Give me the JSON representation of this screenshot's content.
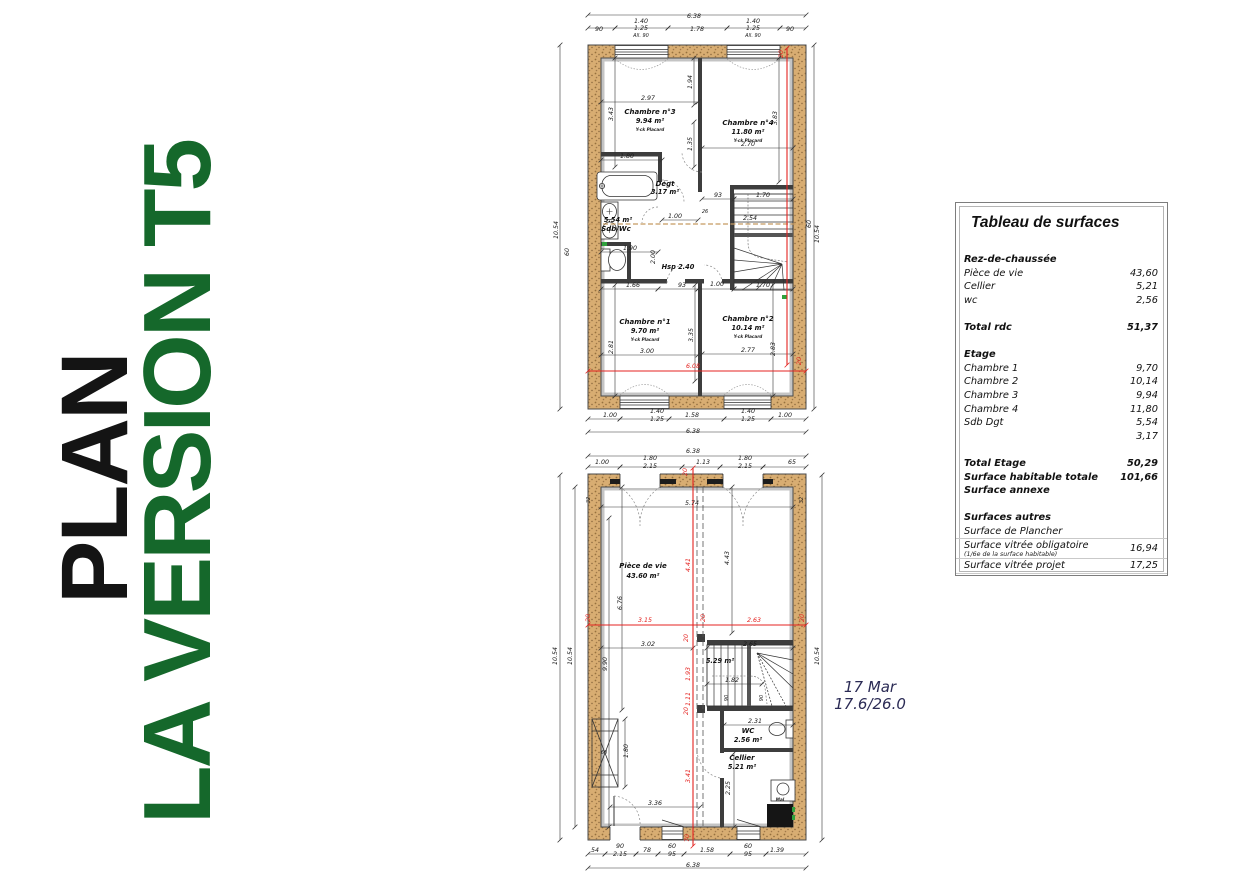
{
  "title": {
    "line1": "PLAN",
    "line2": "LA VERSION T5",
    "accent_color": "#15682b"
  },
  "note": {
    "date": "17 Mar",
    "temps": "17.6/26.0"
  },
  "table": {
    "title": "Tableau de surfaces",
    "rows": [
      {
        "l": "Rez-de-chaussée",
        "v": "",
        "b": 1
      },
      {
        "l": "Pièce de vie",
        "v": "43,60"
      },
      {
        "l": "Cellier",
        "v": "5,21"
      },
      {
        "l": "wc",
        "v": "2,56"
      },
      {
        "sp": 1
      },
      {
        "l": "Total rdc",
        "v": "51,37",
        "b": 1
      },
      {
        "sp": 1
      },
      {
        "l": "Etage",
        "v": "",
        "b": 1
      },
      {
        "l": "Chambre 1",
        "v": "9,70"
      },
      {
        "l": "Chambre 2",
        "v": "10,14"
      },
      {
        "l": "Chambre 3",
        "v": "9,94"
      },
      {
        "l": "Chambre 4",
        "v": "11,80"
      },
      {
        "l": "Sdb Dgt",
        "v": "5,54"
      },
      {
        "l": "",
        "v": "3,17"
      },
      {
        "sp": 1
      },
      {
        "l": "Total Etage",
        "v": "50,29",
        "b": 1
      },
      {
        "l": "Surface habitable totale",
        "v": "101,66",
        "b": 1
      },
      {
        "l": "Surface annexe",
        "v": "",
        "b": 1
      },
      {
        "sp": 1
      },
      {
        "l": "Surfaces autres",
        "v": "",
        "b": 1
      },
      {
        "l": "Surface de Plancher",
        "v": "",
        "hr": 1
      },
      {
        "l": "Surface vitrée obligatoire",
        "n": "(1/6e de la surface habitable)",
        "v": "16,94",
        "hr": 1
      },
      {
        "l": "Surface vitrée projet",
        "v": "17,25",
        "hr": 1
      }
    ]
  },
  "floors": {
    "upper": {
      "labels": [
        [
          142,
          16,
          "6.38"
        ],
        [
          47,
          29,
          "90"
        ],
        [
          89,
          21,
          "1.40"
        ],
        [
          89,
          28,
          "1.25"
        ],
        [
          89,
          35,
          "All. 90",
          "s"
        ],
        [
          145,
          29,
          "1.78"
        ],
        [
          201,
          21,
          "1.40"
        ],
        [
          201,
          28,
          "1.25"
        ],
        [
          201,
          35,
          "All. 90",
          "s"
        ],
        [
          238,
          29,
          "90"
        ],
        [
          6,
          228,
          "10.54",
          "r"
        ],
        [
          17,
          250,
          "60",
          "r"
        ],
        [
          259,
          222,
          "60",
          "r"
        ],
        [
          267,
          232,
          "10.54",
          "r"
        ],
        [
          98,
          112,
          "Chambre n°3",
          "b"
        ],
        [
          98,
          121,
          "9.94 m²",
          "a"
        ],
        [
          98,
          129,
          "Y-ck Placard",
          "t"
        ],
        [
          196,
          123,
          "Chambre n°4",
          "b"
        ],
        [
          196,
          132,
          "11.80 m²",
          "a"
        ],
        [
          196,
          140,
          "Y-ck Placard",
          "t"
        ],
        [
          93,
          322,
          "Chambre n°1",
          "b"
        ],
        [
          93,
          331,
          "9.70 m²",
          "a"
        ],
        [
          93,
          339,
          "Y-ck Placard",
          "t"
        ],
        [
          196,
          319,
          "Chambre n°2",
          "b"
        ],
        [
          196,
          328,
          "10.14 m²",
          "a"
        ],
        [
          196,
          336,
          "Y-ck Placard",
          "t"
        ],
        [
          113,
          184,
          "Dégt",
          "b"
        ],
        [
          113,
          192,
          "3.17 m²",
          "a"
        ],
        [
          66,
          220,
          "5.54 m²",
          "a"
        ],
        [
          64,
          229,
          "Sdb/Wc",
          "b"
        ],
        [
          126,
          267,
          "Hsp 2.40",
          "a"
        ],
        [
          96,
          98,
          "2.97"
        ],
        [
          61,
          112,
          "3.43",
          "r"
        ],
        [
          140,
          80,
          "1.94",
          "r"
        ],
        [
          140,
          142,
          "1.35",
          "r"
        ],
        [
          196,
          144,
          "2.70"
        ],
        [
          225,
          116,
          "3.83",
          "r"
        ],
        [
          75,
          156,
          "1.80"
        ],
        [
          166,
          195,
          "93"
        ],
        [
          211,
          195,
          "1.70"
        ],
        [
          153,
          211,
          "26",
          "s"
        ],
        [
          123,
          216,
          "1.00"
        ],
        [
          198,
          218,
          "2.54"
        ],
        [
          78,
          248,
          "1.90"
        ],
        [
          103,
          255,
          "2.00",
          "r"
        ],
        [
          81,
          285,
          "1.66"
        ],
        [
          130,
          285,
          "93"
        ],
        [
          165,
          284,
          "1.00"
        ],
        [
          211,
          285,
          "1.70"
        ],
        [
          95,
          351,
          "3.00"
        ],
        [
          196,
          350,
          "2.77"
        ],
        [
          141,
          333,
          "3.35",
          "r"
        ],
        [
          61,
          345,
          "2.81",
          "r"
        ],
        [
          223,
          347,
          "2.83",
          "r"
        ],
        [
          58,
          415,
          "1.00"
        ],
        [
          105,
          411,
          "1.40"
        ],
        [
          105,
          419,
          "1.25"
        ],
        [
          140,
          415,
          "1.58"
        ],
        [
          196,
          411,
          "1.40"
        ],
        [
          196,
          419,
          "1.25"
        ],
        [
          233,
          415,
          "1.00"
        ],
        [
          141,
          431,
          "6.38"
        ],
        [
          141,
          366,
          "6.08",
          "R"
        ],
        [
          249,
          359,
          "20",
          "Rr"
        ],
        [
          231,
          52,
          "20",
          "Rr"
        ]
      ],
      "dlines": [
        [
          36,
          13,
          254,
          13
        ],
        [
          36,
          26,
          63,
          26
        ],
        [
          63,
          26,
          116,
          26
        ],
        [
          116,
          26,
          175,
          26
        ],
        [
          175,
          26,
          228,
          26
        ],
        [
          228,
          26,
          254,
          26
        ],
        [
          8,
          43,
          8,
          407
        ],
        [
          262,
          43,
          262,
          407
        ],
        [
          49,
          100,
          146,
          100
        ],
        [
          49,
          158,
          110,
          158
        ],
        [
          150,
          146,
          241,
          146
        ],
        [
          63,
          56,
          63,
          165
        ],
        [
          142,
          56,
          142,
          103
        ],
        [
          142,
          120,
          142,
          165
        ],
        [
          227,
          56,
          227,
          180
        ],
        [
          150,
          197,
          182,
          197
        ],
        [
          182,
          197,
          241,
          197
        ],
        [
          110,
          218,
          146,
          218
        ],
        [
          49,
          250,
          106,
          250
        ],
        [
          49,
          287,
          106,
          287
        ],
        [
          106,
          287,
          146,
          287
        ],
        [
          146,
          287,
          182,
          287
        ],
        [
          182,
          287,
          241,
          287
        ],
        [
          49,
          353,
          146,
          353
        ],
        [
          150,
          352,
          241,
          352
        ],
        [
          63,
          283,
          63,
          394
        ],
        [
          143,
          283,
          143,
          379
        ],
        [
          221,
          283,
          221,
          394
        ],
        [
          36,
          417,
          68,
          417
        ],
        [
          68,
          417,
          117,
          417
        ],
        [
          117,
          417,
          172,
          417
        ],
        [
          172,
          417,
          219,
          417
        ],
        [
          219,
          417,
          254,
          417
        ],
        [
          36,
          430,
          254,
          430
        ],
        [
          36,
          369,
          254,
          369,
          "R"
        ],
        [
          235,
          46,
          235,
          363,
          "R"
        ]
      ]
    },
    "lower": {
      "labels": [
        [
          141,
          5,
          "6.38"
        ],
        [
          50,
          16,
          "1.00"
        ],
        [
          98,
          12,
          "1.80"
        ],
        [
          98,
          20,
          "2.15"
        ],
        [
          151,
          16,
          "1.13"
        ],
        [
          193,
          12,
          "1.80"
        ],
        [
          193,
          20,
          "2.15"
        ],
        [
          240,
          16,
          "65"
        ],
        [
          135,
          24,
          "20",
          "Rr"
        ],
        [
          5,
          208,
          "10.54",
          "r"
        ],
        [
          20,
          208,
          "10.54",
          "r"
        ],
        [
          267,
          208,
          "10.54",
          "r"
        ],
        [
          38,
          52,
          "32",
          "rs"
        ],
        [
          251,
          52,
          "32",
          "rs"
        ],
        [
          91,
          120,
          "Pièce de vie",
          "b"
        ],
        [
          91,
          130,
          "43.60 m²",
          "a"
        ],
        [
          168,
          215,
          "5.29 m²",
          "a"
        ],
        [
          196,
          285,
          "WC",
          "b"
        ],
        [
          196,
          294,
          "2.56 m²",
          "a"
        ],
        [
          190,
          312,
          "Cellier",
          "b"
        ],
        [
          190,
          321,
          "5.21 m²",
          "a"
        ],
        [
          228,
          353,
          "Mal",
          "t"
        ],
        [
          140,
          57,
          "5.74"
        ],
        [
          177,
          110,
          "4.43",
          "r"
        ],
        [
          55,
          216,
          "9.90",
          "r"
        ],
        [
          70,
          155,
          "6.76",
          "r"
        ],
        [
          96,
          198,
          "3.02"
        ],
        [
          198,
          198,
          "2.65"
        ],
        [
          180,
          234,
          "1.82"
        ],
        [
          176,
          250,
          "90",
          "rs"
        ],
        [
          211,
          250,
          "90",
          "rs"
        ],
        [
          203,
          275,
          "2.31"
        ],
        [
          178,
          340,
          "2.25",
          "r"
        ],
        [
          103,
          357,
          "3.36"
        ],
        [
          76,
          303,
          "1.80",
          "r"
        ],
        [
          52,
          306,
          "60",
          "s"
        ],
        [
          43,
          404,
          "54"
        ],
        [
          68,
          400,
          "90"
        ],
        [
          68,
          408,
          "2.15"
        ],
        [
          95,
          404,
          "78"
        ],
        [
          120,
          400,
          "60"
        ],
        [
          120,
          408,
          "95"
        ],
        [
          155,
          404,
          "1.58"
        ],
        [
          196,
          400,
          "60"
        ],
        [
          196,
          408,
          "95"
        ],
        [
          225,
          404,
          "1.39"
        ],
        [
          141,
          419,
          "6.38"
        ],
        [
          138,
          117,
          "4.41",
          "Rr"
        ],
        [
          93,
          174,
          "3.15",
          "R"
        ],
        [
          202,
          174,
          "2.63",
          "R"
        ],
        [
          38,
          170,
          "20",
          "Rr"
        ],
        [
          153,
          170,
          "20",
          "Rr"
        ],
        [
          252,
          170,
          "20",
          "Rr"
        ],
        [
          136,
          190,
          "20",
          "Rr"
        ],
        [
          138,
          226,
          "1.93",
          "Rr"
        ],
        [
          138,
          251,
          "1.11",
          "Rr"
        ],
        [
          136,
          263,
          "20",
          "Rr"
        ],
        [
          138,
          328,
          "3.41",
          "Rr"
        ],
        [
          137,
          390,
          "70",
          "Rr"
        ]
      ],
      "dlines": [
        [
          36,
          8,
          254,
          8
        ],
        [
          36,
          19,
          68,
          19
        ],
        [
          68,
          19,
          130,
          19
        ],
        [
          130,
          19,
          168,
          19
        ],
        [
          168,
          19,
          211,
          19
        ],
        [
          211,
          19,
          254,
          19
        ],
        [
          8,
          27,
          8,
          392
        ],
        [
          23,
          39,
          23,
          379
        ],
        [
          270,
          27,
          270,
          392
        ],
        [
          49,
          59,
          241,
          59
        ],
        [
          49,
          200,
          141,
          200
        ],
        [
          155,
          200,
          241,
          200
        ],
        [
          57,
          70,
          57,
          379
        ],
        [
          70,
          39,
          70,
          262
        ],
        [
          180,
          39,
          180,
          185
        ],
        [
          155,
          236,
          210,
          236
        ],
        [
          172,
          277,
          241,
          277
        ],
        [
          182,
          305,
          182,
          379
        ],
        [
          73,
          271,
          73,
          339
        ],
        [
          58,
          359,
          148,
          359
        ],
        [
          36,
          406,
          53,
          406
        ],
        [
          53,
          406,
          84,
          406
        ],
        [
          84,
          406,
          106,
          406
        ],
        [
          106,
          406,
          132,
          406
        ],
        [
          132,
          406,
          178,
          406
        ],
        [
          178,
          406,
          214,
          406
        ],
        [
          214,
          406,
          254,
          406
        ],
        [
          36,
          420,
          254,
          420
        ],
        [
          36,
          177,
          254,
          177,
          "R"
        ],
        [
          141,
          20,
          141,
          398,
          "R"
        ]
      ]
    }
  }
}
